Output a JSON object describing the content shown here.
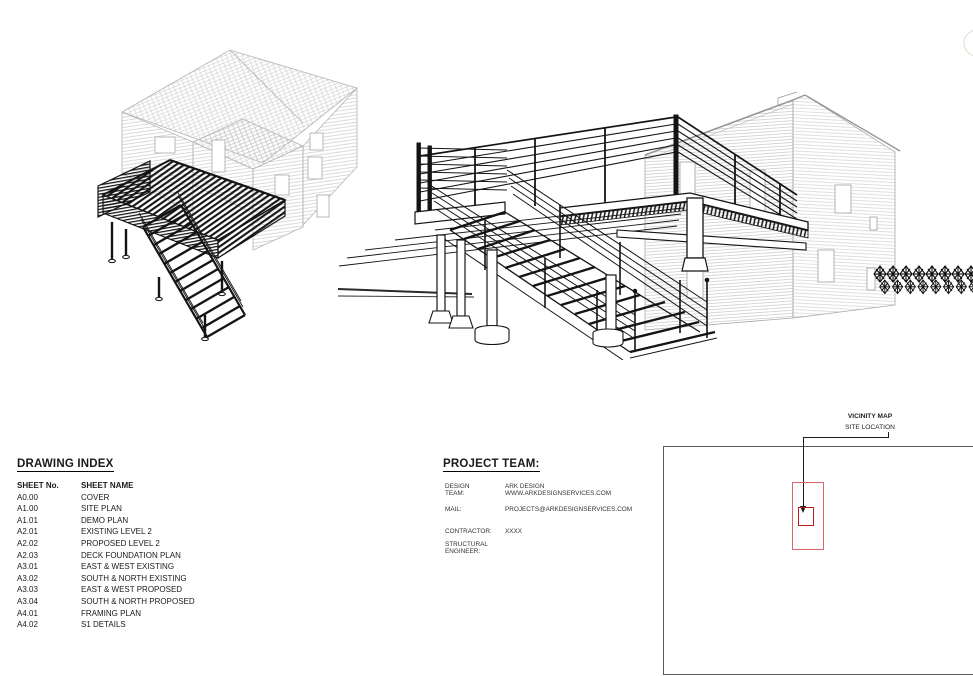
{
  "sheet": {
    "type": "architectural-cover-sheet"
  },
  "drawing_index": {
    "title": "DRAWING INDEX",
    "columns": [
      "SHEET No.",
      "SHEET NAME"
    ],
    "rows": [
      [
        "A0.00",
        "COVER"
      ],
      [
        "A1.00",
        "SITE PLAN"
      ],
      [
        "A1.01",
        "DEMO PLAN"
      ],
      [
        "A2.01",
        "EXISTING LEVEL 2"
      ],
      [
        "A2.02",
        "PROPOSED LEVEL 2"
      ],
      [
        "A2.03",
        "DECK FOUNDATION PLAN"
      ],
      [
        "A3.01",
        "EAST & WEST EXISTING"
      ],
      [
        "A3.02",
        "SOUTH & NORTH EXISTING"
      ],
      [
        "A3.03",
        "EAST & WEST PROPOSED"
      ],
      [
        "A3.04",
        "SOUTH & NORTH PROPOSED"
      ],
      [
        "A4.01",
        "FRAMING PLAN"
      ],
      [
        "A4.02",
        "S1 DETAILS"
      ]
    ]
  },
  "project_team": {
    "title": "PROJECT TEAM:",
    "entries": [
      {
        "label": "DESIGN\nTEAM:",
        "value": "ARK DESIGN\nWWW.ARKDESIGNSERVICES.COM"
      },
      {
        "label": "MAIL:",
        "value": "PROJECTS@ARKDESIGNSERVICES.COM"
      },
      {
        "label": "CONTRACTOR:",
        "value": "XXXX"
      },
      {
        "label": "STRUCTURAL\nENGINEER:",
        "value": ""
      }
    ]
  },
  "vicinity_map": {
    "title": "VICINITY MAP",
    "subtitle": "SITE LOCATION"
  },
  "illustrations": {
    "left": "deck-framing-house-isometric",
    "right": "deck-stair-perspective-detail"
  },
  "colors": {
    "drawing_ink": "#141414",
    "house_ink": "#b4b4b4",
    "map_border": "#5a5a5a",
    "marker_outer": "#e06666",
    "marker_inner": "#c01a1a"
  }
}
